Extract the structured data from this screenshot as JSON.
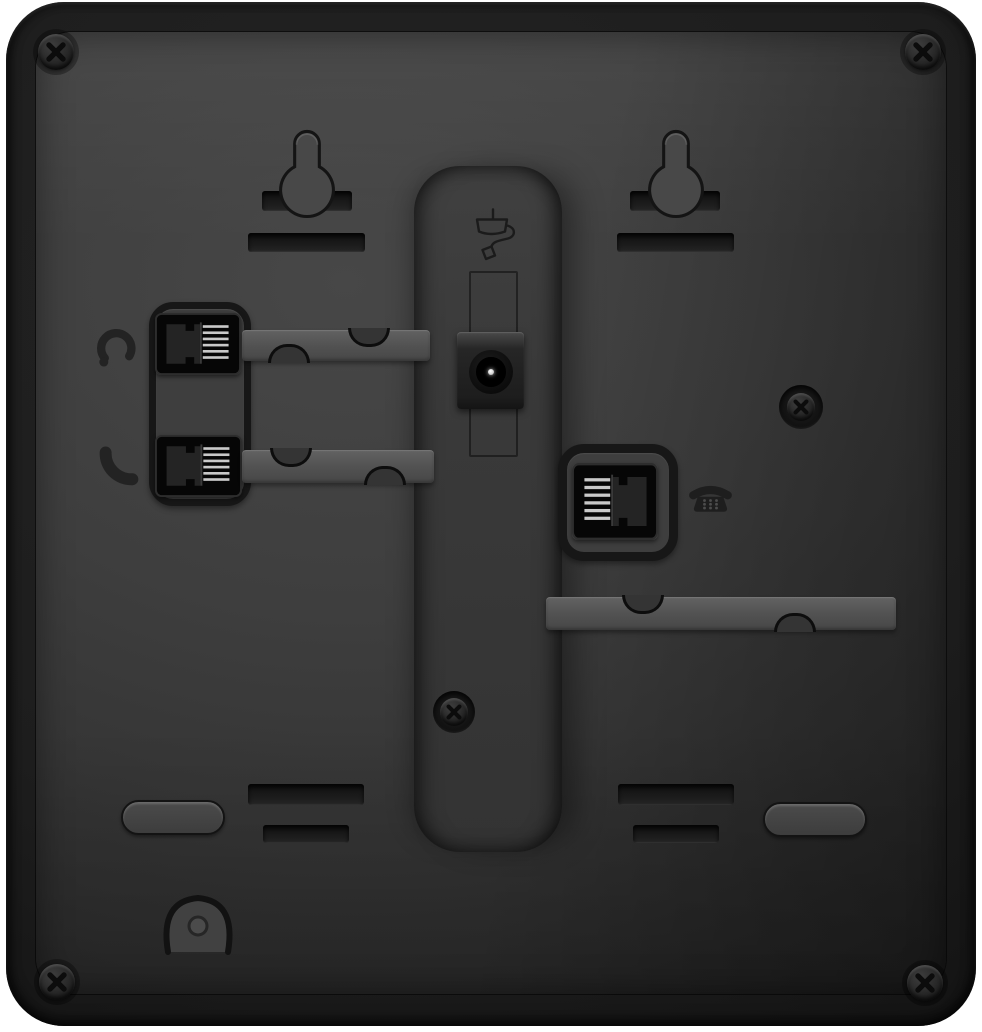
{
  "photo": {
    "subject": "Rear panel of a black desktop telephone",
    "background_color": "#ffffff"
  },
  "palette": {
    "shell": "#1a1a1a",
    "panel": "#3d3d3d",
    "panel_shadow": "#272727",
    "stand_channel": "#383838",
    "cable_channel": "#565656",
    "slot": "#161616",
    "jack_opening": "#060606",
    "pin_highlight": "#d0d0d0",
    "dc_pin": "#f5f5f5",
    "icon_ink": "#202020"
  },
  "components": {
    "wall_mount_keyholes": [
      "left",
      "right"
    ],
    "wall_mount_slots": [
      "left-behind",
      "right-behind",
      "left-below",
      "right-below"
    ],
    "screws": [
      "top-left",
      "top-right",
      "middle-right",
      "center",
      "bottom-left",
      "bottom-right"
    ],
    "ports": [
      {
        "name": "headset-jack",
        "icon": "headset-icon"
      },
      {
        "name": "handset-jack",
        "icon": "handset-icon"
      },
      {
        "name": "dc-power-jack",
        "icon": "power-adapter-icon"
      },
      {
        "name": "phone-line-jack",
        "icon": "telephone-icon"
      }
    ],
    "cable_channels": [
      "headset-channel",
      "handset-channel",
      "line-channel"
    ],
    "feet": [
      "bottom-left",
      "bottom-right"
    ],
    "vent_slots": [
      "bottom-left-pair",
      "bottom-right-pair"
    ],
    "cable_hook": "bottom-center-left"
  },
  "labels": {
    "device": "telephone rear panel",
    "shell": "device shell",
    "panel": "rear panel surface",
    "stand_channel": "stand recess channel",
    "keyhole": "wall-mount keyhole",
    "mount_slot": "wall-mount slot",
    "headset_jack": "headset modular jack",
    "handset_jack": "handset modular jack",
    "dc_jack": "DC power barrel jack",
    "line_jack": "phone line modular jack",
    "headset_icon": "headset icon",
    "handset_icon": "handset icon",
    "power_icon": "power adapter icon",
    "phone_icon": "telephone icon",
    "cable_channel": "cable routing channel",
    "screw": "phillips screw",
    "foot": "rubber foot recess",
    "vent_slot": "vent slot",
    "cable_hook": "cable hook"
  }
}
